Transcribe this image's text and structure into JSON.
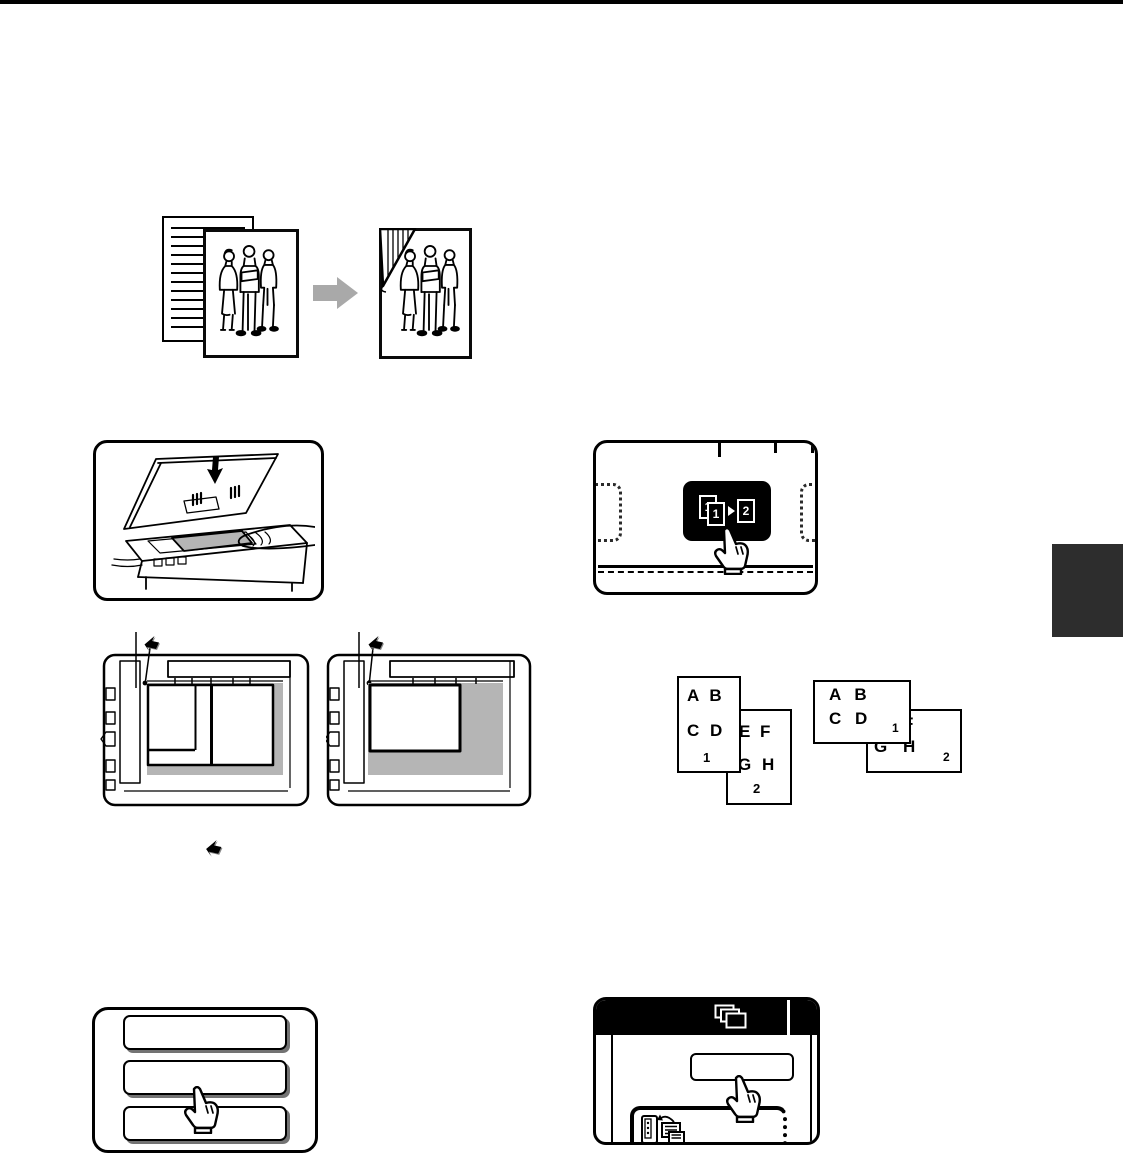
{
  "colors": {
    "page_background": "#ffffff",
    "ink": "#000000",
    "glass_shade": "#b5b5b5",
    "transition_arrow": "#a9a9a9",
    "chapter_tab": "#2d2d2d",
    "key_background": "#000000",
    "key_foreground": "#ffffff"
  },
  "labels": {
    "duplex_key": {
      "front": "1",
      "back": "1",
      "result": "2"
    },
    "portrait": {
      "front": {
        "row1": "A B",
        "row2": "C D",
        "page": "1"
      },
      "back": {
        "row1": "E F",
        "row2": "G H",
        "page": "2"
      }
    },
    "landscape": {
      "front": {
        "row1": "A B",
        "row2": "C D",
        "page": "1"
      },
      "back": {
        "row1": "E F",
        "row2": "G H",
        "page": "2"
      }
    }
  },
  "icons": {
    "position_mark": "original-position-mark",
    "down_arrow": "set-original-arrow",
    "right_arrow": "copy-transition-arrow",
    "copies_header": "copies-pages",
    "feeder": "original-to-copy",
    "hand": "press-key-hand"
  }
}
